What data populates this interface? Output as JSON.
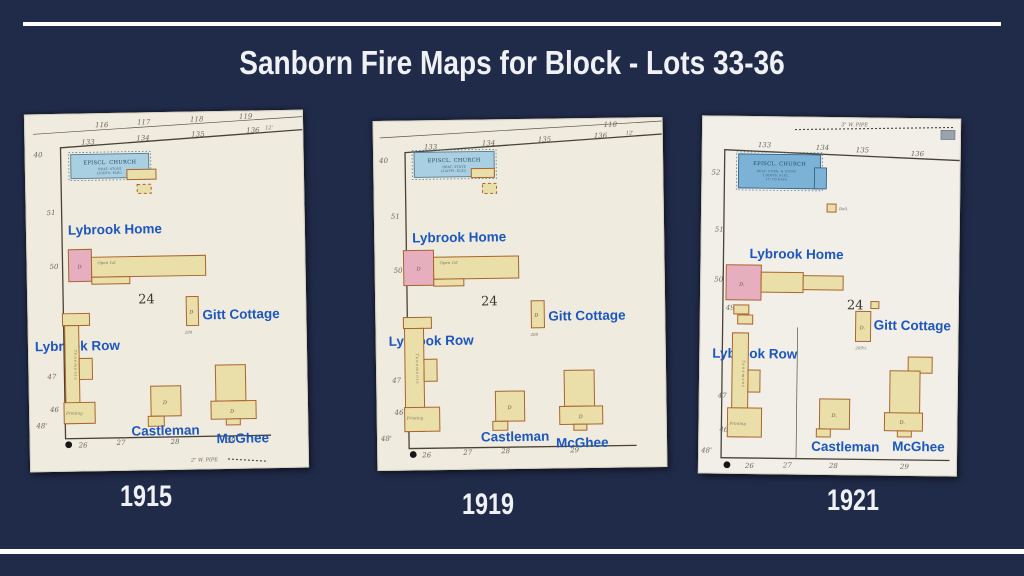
{
  "slide": {
    "title": "Sanborn Fire Maps for Block - Lots 33-36",
    "background_color": "#202b49",
    "rule_color": "#ffffff",
    "map_label_color": "#1c56c0",
    "paper_color": "#efebde",
    "building_yellow": "#eadfa9",
    "building_pink": "#e6aebe",
    "church_blue_1915_1919": "#a9cfe2",
    "church_blue_1921": "#7cb2d6"
  },
  "maps": [
    {
      "year": "1915",
      "church": {
        "name": "EPISCL. CHURCH",
        "sub1": "HEAT: STOVE",
        "sub2": "LIGHTS: ELEC."
      },
      "labels": {
        "home": "Lybrook Home",
        "row": "Lybrook Row",
        "gitt": "Gitt Cottage",
        "castleman": "Castleman",
        "mcghee": "McGhee"
      },
      "block_number": "24",
      "upper_street_numbers": [
        "116",
        "117",
        "118",
        "119"
      ],
      "street_numbers_top": [
        "133",
        "134",
        "135",
        "136"
      ],
      "street_numbers_bottom": [
        "26",
        "27",
        "28",
        "29"
      ],
      "left_numbers": [
        "40",
        "51",
        "50",
        "47",
        "46"
      ],
      "corner_dimension": "48'",
      "width_tick": "12'",
      "house_number": "288",
      "dwelling_marker": "D",
      "row_text": "Tenements",
      "row_text2": "Printing",
      "open_text": "Open 1st",
      "pipe_note": "2\" W. PIPE"
    },
    {
      "year": "1919",
      "church": {
        "name": "EPISCL. CHURCH",
        "sub1": "HEAT: STOVE",
        "sub2": "LIGHTS: ELEC."
      },
      "labels": {
        "home": "Lybrook Home",
        "row": "Lybrook Row",
        "gitt": "Gitt Cottage",
        "castleman": "Castleman",
        "mcghee": "McGhee"
      },
      "block_number": "24",
      "upper_street_numbers": [
        "118"
      ],
      "street_numbers_top": [
        "133",
        "134",
        "135",
        "136"
      ],
      "street_numbers_bottom": [
        "26",
        "27",
        "28",
        "29"
      ],
      "left_numbers": [
        "40",
        "51",
        "50",
        "47",
        "46"
      ],
      "corner_dimension": "48'",
      "width_tick": "12'",
      "house_number": "288",
      "dwelling_marker": "D",
      "row_text": "Tenements",
      "row_text2": "Printing",
      "open_text": "Open 1st"
    },
    {
      "year": "1921",
      "church": {
        "name": "EPISCL. CHURCH",
        "sub1": "HEAT: FURN. & STOVE",
        "sub2": "LIGHTS: ELEC.",
        "sub3": "15' TO EAVE"
      },
      "labels": {
        "home": "Lybrook Home",
        "row": "Lybrook Row",
        "gitt": "Gitt Cottage",
        "castleman": "Castleman",
        "mcghee": "McGhee"
      },
      "block_number": "24",
      "street_numbers_top": [
        "133",
        "134",
        "135",
        "136"
      ],
      "street_numbers_bottom": [
        "26",
        "27",
        "28",
        "29"
      ],
      "left_numbers": [
        "52",
        "51",
        "50",
        "49",
        "47",
        "46"
      ],
      "corner_dimension": "48'",
      "house_number": "289½",
      "dwelling_marker": "D.",
      "row_text": "Tenement",
      "row_text2": "Printing",
      "outbuilding_note": "Balt.",
      "pipe_note_top": "3\" W. PIPE"
    }
  ]
}
